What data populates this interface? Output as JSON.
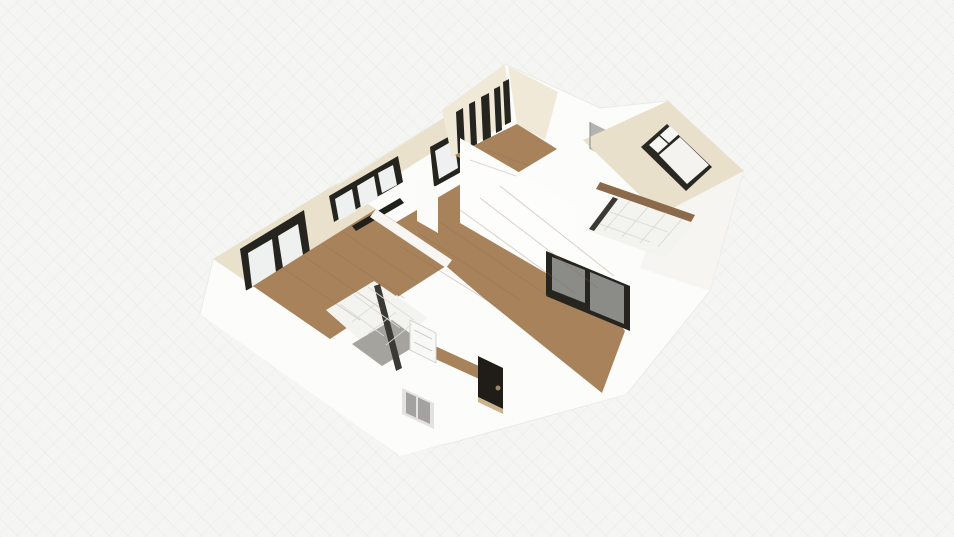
{
  "scene": {
    "canvas": {
      "width": 954,
      "height": 537
    },
    "background": "#f5f5f4",
    "colors": {
      "wall_white": "#fcfcfa",
      "wall_cream": "#e9e1cc",
      "cream_light": "#f0e9d8",
      "wood_floor": "#a8825a",
      "wood_line": "#8f6c49",
      "tile_floor": "#f3f3f0",
      "tile_line": "#dcdbd6",
      "frame_dark": "#26241e",
      "pane_white": "#eff1f0",
      "glass_gray": "#8b8b88",
      "shower_gray": "#a5a39e",
      "wall_top_brown": "#8a6a4b",
      "entry_door_dark": "#201d18"
    },
    "polygons": [
      {
        "name": "building-base-walls",
        "fill": "#fcfcfa",
        "stroke": "#ebeae7",
        "points": "200,314 213,260 336,185 452,113 505,64 600,108 668,101 743,172 710,291 627,394 455,442 398,455 275,362"
      },
      {
        "name": "left-bedroom-wall-band",
        "fill": "#e9e1cc",
        "points": "213,259 336,184 376,209 253,286"
      },
      {
        "name": "left-bedroom-window-frame",
        "fill": "#26241e",
        "points": "240,249 304,210 310,252 246,291"
      },
      {
        "name": "left-bedroom-window-pane-left",
        "fill": "#eff1f0",
        "points": "248,253 272,239 276,272 252,287"
      },
      {
        "name": "left-bedroom-window-pane-right",
        "fill": "#eff1f0",
        "points": "278,236 298,224 303,255 283,268"
      },
      {
        "name": "left-bedroom-wood-floor",
        "fill": "#a8825a",
        "points": "253,286 376,209 452,259 330,339"
      },
      {
        "name": "living-nw-wall-band",
        "fill": "#e9e1cc",
        "points": "330,190 452,113 474,126 352,203"
      },
      {
        "name": "living-window-1-frame",
        "fill": "#26241e",
        "points": "329,196 398,156 403,182 334,222"
      },
      {
        "name": "living-window-1-pane-a",
        "fill": "#eff1f0",
        "points": "335,199 352,189 356,211 339,221"
      },
      {
        "name": "living-window-1-pane-b",
        "fill": "#eff1f0",
        "points": "357,186 374,176 378,198 361,208"
      },
      {
        "name": "living-window-1-pane-c",
        "fill": "#eff1f0",
        "points": "378,173 393,165 397,185 382,193"
      },
      {
        "name": "living-window-2-frame",
        "fill": "#26241e",
        "points": "430,147 459,131 463,171 434,187"
      },
      {
        "name": "living-window-2-pane",
        "fill": "#eff1f0",
        "points": "435,151 454,140 458,168 439,179"
      },
      {
        "name": "living-window-sill",
        "fill": "#20201b",
        "points": "352,226 400,198 404,203 356,231"
      },
      {
        "name": "living-room-wood-floor",
        "fill": "#a8825a",
        "points": "366,240 505,158 542,228 625,331 602,393 470,386 436,360 405,312 385,268"
      },
      {
        "name": "living-wall-column",
        "fill": "#fbfbf9",
        "points": "417,176 438,188 438,233 417,221"
      },
      {
        "name": "left-living-divider-wall",
        "fill": "#f7f6f3",
        "points": "376,209 452,260 446,268 370,217"
      },
      {
        "name": "top-room-back-wall",
        "fill": "#f0e9d8",
        "points": "442,110 505,64 512,120 452,158"
      },
      {
        "name": "top-room-dark-panel-1",
        "fill": "#26241e",
        "points": "456,112 463,108 465,150 458,154"
      },
      {
        "name": "top-room-dark-panel-2",
        "fill": "#26241e",
        "points": "469,104 475,101 477,144 471,147"
      },
      {
        "name": "top-room-dark-panel-3",
        "fill": "#26241e",
        "points": "481,97 489,93 491,137 483,141"
      },
      {
        "name": "top-room-dark-panel-4",
        "fill": "#26241e",
        "points": "494,89 500,86 502,130 496,133"
      },
      {
        "name": "top-room-dark-panel-5",
        "fill": "#26241e",
        "points": "503,82 509,79 511,122 505,125"
      },
      {
        "name": "top-room-wood-floor",
        "fill": "#a8825a",
        "points": "455,155 517,124 557,149 499,184"
      },
      {
        "name": "top-room-right-wall",
        "fill": "#f0e9d8",
        "points": "508,66 558,92 545,140 517,124"
      },
      {
        "name": "top-room-front-wall",
        "fill": "#fdfdfc",
        "points": "460,138 577,206 577,291 460,223"
      },
      {
        "name": "hallway-gray-door",
        "fill": "#b5b3af",
        "points": "590,122 616,135 616,162 590,149"
      },
      {
        "name": "right-bedroom-floor",
        "fill": "#e8e0cb",
        "points": "583,140 668,101 744,171 660,215"
      },
      {
        "name": "bed-frame",
        "fill": "#2a2822",
        "points": "641,147 667,124 712,167 686,191"
      },
      {
        "name": "bed-pillow-1",
        "fill": "#f6f6f4",
        "points": "649,145 659,136 668,144 658,153"
      },
      {
        "name": "bed-pillow-2",
        "fill": "#f6f6f4",
        "points": "660,135 670,126 679,134 669,143"
      },
      {
        "name": "bed-duvet",
        "fill": "#f4f3f0",
        "points": "659,155 680,137 709,165 687,184"
      },
      {
        "name": "right-exterior-wall-shade",
        "fill": "#f6f5f1",
        "points": "658,216 742,172 710,291 640,268"
      },
      {
        "name": "bedroom-wall-top-strip",
        "fill": "#8a6a4b",
        "points": "600,182 695,215 691,222 596,189"
      },
      {
        "name": "right-bathroom-tile-floor",
        "fill": "#f3f3f0",
        "points": "616,196 694,224 664,258 586,230"
      },
      {
        "name": "right-bathroom-glass-edge",
        "fill": "#3b3934",
        "points": "613,197 618,199 594,231 589,229"
      },
      {
        "name": "sliding-glass-door-frame",
        "fill": "#26241e",
        "points": "546,251 630,286 630,331 546,296"
      },
      {
        "name": "sliding-glass-door-pane-left",
        "fill": "#8b8b88",
        "points": "552,257 585,270 585,303 552,290"
      },
      {
        "name": "sliding-glass-door-pane-right",
        "fill": "#8b8b88",
        "points": "590,272 624,286 624,324 590,310"
      },
      {
        "name": "front-wall-mass",
        "fill": "#fcfcfa",
        "points": "200,314 253,287 330,340 446,266 480,295 602,393 627,394 400,456"
      },
      {
        "name": "entry-hall-wood-strip",
        "fill": "#a8825a",
        "points": "424,341 492,372 488,383 420,352"
      },
      {
        "name": "left-bathroom-tile-floor",
        "fill": "#f3f3f0",
        "points": "326,310 374,281 428,318 378,356"
      },
      {
        "name": "left-bathroom-shower-floor",
        "fill": "#a5a39e",
        "points": "352,344 392,320 422,342 382,366"
      },
      {
        "name": "left-bathroom-glass-panel",
        "fill": "#3b3934",
        "points": "374,286 380,284 402,368 396,371"
      },
      {
        "name": "bathroom-white-door",
        "fill": "#f8f8f6",
        "stroke": "#d5d4d0",
        "points": "410,320 436,333 436,363 410,350"
      },
      {
        "name": "lower-exterior-window-frame",
        "fill": "#e3e2df",
        "points": "402,388 434,403 434,429 402,414"
      },
      {
        "name": "lower-exterior-window-glass",
        "fill": "#a3a2a0",
        "points": "406,392 430,403 430,424 406,413"
      },
      {
        "name": "entry-door",
        "fill": "#201d18",
        "points": "478,356 503,368 503,409 478,397"
      },
      {
        "name": "entry-door-sill",
        "fill": "#c9b28c",
        "points": "478,397 503,409 503,414 478,402"
      }
    ],
    "lines": [
      {
        "name": "living-plank-line",
        "x1": 400,
        "y1": 246,
        "x2": 496,
        "y2": 306,
        "stroke": "#8f6c49",
        "opacity": 0.3,
        "width": 1
      },
      {
        "name": "living-plank-line",
        "x1": 420,
        "y1": 234,
        "x2": 520,
        "y2": 300,
        "stroke": "#8f6c49",
        "opacity": 0.3,
        "width": 1
      },
      {
        "name": "living-plank-line",
        "x1": 440,
        "y1": 222,
        "x2": 548,
        "y2": 296,
        "stroke": "#8f6c49",
        "opacity": 0.3,
        "width": 1
      },
      {
        "name": "living-plank-line",
        "x1": 460,
        "y1": 210,
        "x2": 575,
        "y2": 293,
        "stroke": "#8f6c49",
        "opacity": 0.3,
        "width": 1
      },
      {
        "name": "living-plank-line",
        "x1": 480,
        "y1": 198,
        "x2": 598,
        "y2": 288,
        "stroke": "#8f6c49",
        "opacity": 0.3,
        "width": 1
      },
      {
        "name": "living-plank-line",
        "x1": 500,
        "y1": 186,
        "x2": 614,
        "y2": 276,
        "stroke": "#8f6c49",
        "opacity": 0.3,
        "width": 1
      },
      {
        "name": "left-room-plank-line",
        "x1": 283,
        "y1": 268,
        "x2": 360,
        "y2": 320,
        "stroke": "#8f6c49",
        "opacity": 0.3,
        "width": 1
      },
      {
        "name": "left-room-plank-line",
        "x1": 303,
        "y1": 256,
        "x2": 382,
        "y2": 309,
        "stroke": "#8f6c49",
        "opacity": 0.3,
        "width": 1
      },
      {
        "name": "left-room-plank-line",
        "x1": 323,
        "y1": 244,
        "x2": 404,
        "y2": 298,
        "stroke": "#8f6c49",
        "opacity": 0.3,
        "width": 1
      },
      {
        "name": "left-room-plank-line",
        "x1": 343,
        "y1": 232,
        "x2": 414,
        "y2": 280,
        "stroke": "#8f6c49",
        "opacity": 0.3,
        "width": 1
      },
      {
        "name": "top-room-plank-line",
        "x1": 470,
        "y1": 160,
        "x2": 516,
        "y2": 176,
        "stroke": "#8f6c49",
        "opacity": 0.25,
        "width": 1
      },
      {
        "name": "top-room-plank-line",
        "x1": 486,
        "y1": 150,
        "x2": 530,
        "y2": 166,
        "stroke": "#8f6c49",
        "opacity": 0.25,
        "width": 1
      },
      {
        "name": "left-tile-grid-line",
        "x1": 340,
        "y1": 304,
        "x2": 384,
        "y2": 336,
        "stroke": "#dcdbd6",
        "opacity": 0.9,
        "width": 1
      },
      {
        "name": "left-tile-grid-line",
        "x1": 354,
        "y1": 295,
        "x2": 400,
        "y2": 328,
        "stroke": "#dcdbd6",
        "opacity": 0.9,
        "width": 1
      },
      {
        "name": "left-tile-grid-line",
        "x1": 368,
        "y1": 287,
        "x2": 414,
        "y2": 320,
        "stroke": "#dcdbd6",
        "opacity": 0.9,
        "width": 1
      },
      {
        "name": "left-tile-grid-line",
        "x1": 352,
        "y1": 322,
        "x2": 378,
        "y2": 302,
        "stroke": "#dcdbd6",
        "opacity": 0.9,
        "width": 1
      },
      {
        "name": "left-tile-grid-line",
        "x1": 368,
        "y1": 334,
        "x2": 396,
        "y2": 312,
        "stroke": "#dcdbd6",
        "opacity": 0.9,
        "width": 1
      },
      {
        "name": "left-tile-grid-line",
        "x1": 386,
        "y1": 345,
        "x2": 412,
        "y2": 324,
        "stroke": "#dcdbd6",
        "opacity": 0.9,
        "width": 1
      },
      {
        "name": "right-tile-grid-line",
        "x1": 630,
        "y1": 201,
        "x2": 604,
        "y2": 231,
        "stroke": "#dcdbd6",
        "opacity": 0.9,
        "width": 1
      },
      {
        "name": "right-tile-grid-line",
        "x1": 648,
        "y1": 207,
        "x2": 622,
        "y2": 237,
        "stroke": "#dcdbd6",
        "opacity": 0.9,
        "width": 1
      },
      {
        "name": "right-tile-grid-line",
        "x1": 666,
        "y1": 213,
        "x2": 640,
        "y2": 243,
        "stroke": "#dcdbd6",
        "opacity": 0.9,
        "width": 1
      },
      {
        "name": "right-tile-grid-line",
        "x1": 682,
        "y1": 219,
        "x2": 658,
        "y2": 247,
        "stroke": "#dcdbd6",
        "opacity": 0.9,
        "width": 1
      },
      {
        "name": "right-tile-grid-line",
        "x1": 610,
        "y1": 212,
        "x2": 668,
        "y2": 232,
        "stroke": "#dcdbd6",
        "opacity": 0.9,
        "width": 1
      },
      {
        "name": "right-tile-grid-line",
        "x1": 600,
        "y1": 224,
        "x2": 650,
        "y2": 242,
        "stroke": "#dcdbd6",
        "opacity": 0.9,
        "width": 1
      },
      {
        "name": "bathroom-door-panel-line",
        "x1": 414,
        "y1": 330,
        "x2": 432,
        "y2": 339,
        "stroke": "#d0cfcb",
        "opacity": 1,
        "width": 1
      },
      {
        "name": "bathroom-door-panel-line",
        "x1": 414,
        "y1": 342,
        "x2": 432,
        "y2": 351,
        "stroke": "#d0cfcb",
        "opacity": 1,
        "width": 1
      },
      {
        "name": "lower-window-mullion",
        "x1": 417,
        "y1": 395,
        "x2": 417,
        "y2": 418,
        "stroke": "#e3e2df",
        "opacity": 1,
        "width": 2
      },
      {
        "name": "hall-door-edge",
        "x1": 590,
        "y1": 122,
        "x2": 590,
        "y2": 149,
        "stroke": "#8a8885",
        "opacity": 1,
        "width": 1
      }
    ],
    "circles": [
      {
        "name": "entry-door-knob",
        "cx": 498,
        "cy": 388,
        "r": 2.5,
        "fill": "#9a8767"
      }
    ]
  }
}
